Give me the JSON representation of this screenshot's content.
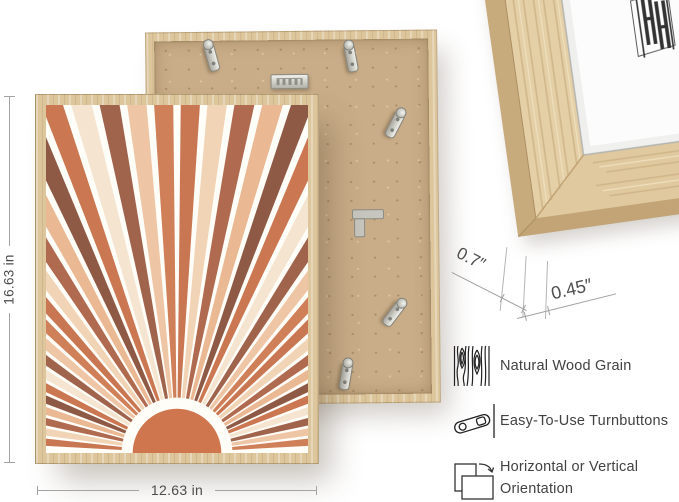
{
  "image_title": "picture frame product infographic",
  "dimensions": {
    "height_label": "16.63 in",
    "width_label": "12.63 in"
  },
  "corner": {
    "depth_label": "0.7″",
    "face_label": "0.45″"
  },
  "features": {
    "items": [
      {
        "icon": "wood-grain-icon",
        "label": "Natural Wood Grain"
      },
      {
        "icon": "turnbutton-icon",
        "label": "Easy-To-Use Turnbuttons"
      },
      {
        "icon": "orientation-icon",
        "label": "Horizontal or Vertical Orientation"
      }
    ]
  },
  "art": {
    "type": "sunburst",
    "background": "#fffdf8",
    "sun_color": "#d0764f",
    "sun_radius": 44,
    "ray_inner_radius": 55,
    "ray_count": 40,
    "angle_start": 2.5,
    "angle_end": 177.5,
    "ray_fill_ratio": 0.72,
    "ray_palette": [
      "#d08059",
      "#efc6a5",
      "#a0644d",
      "#f4e4d0",
      "#cb7752",
      "#8e5a45",
      "#eab893",
      "#b06a50",
      "#f1d4b6",
      "#c97753"
    ]
  },
  "materials": {
    "wood": "#ddc69c",
    "wood_light": "#e9d9b8",
    "wood_dark": "#c6a97c",
    "mdf": "#c9ad88",
    "metal": "#c9c9c4",
    "mat_white": "#fcfcfc",
    "line_gray": "#a3a3a3",
    "text_gray": "#4c4c4c",
    "logo_ink": "#333333"
  },
  "back_frame": {
    "hardware": [
      "turnbutton",
      "turnbutton",
      "turnbutton",
      "turnbutton",
      "turnbutton",
      "sawtooth-hanger",
      "corner-bracket"
    ]
  },
  "brand_logo": "HH-monogram"
}
